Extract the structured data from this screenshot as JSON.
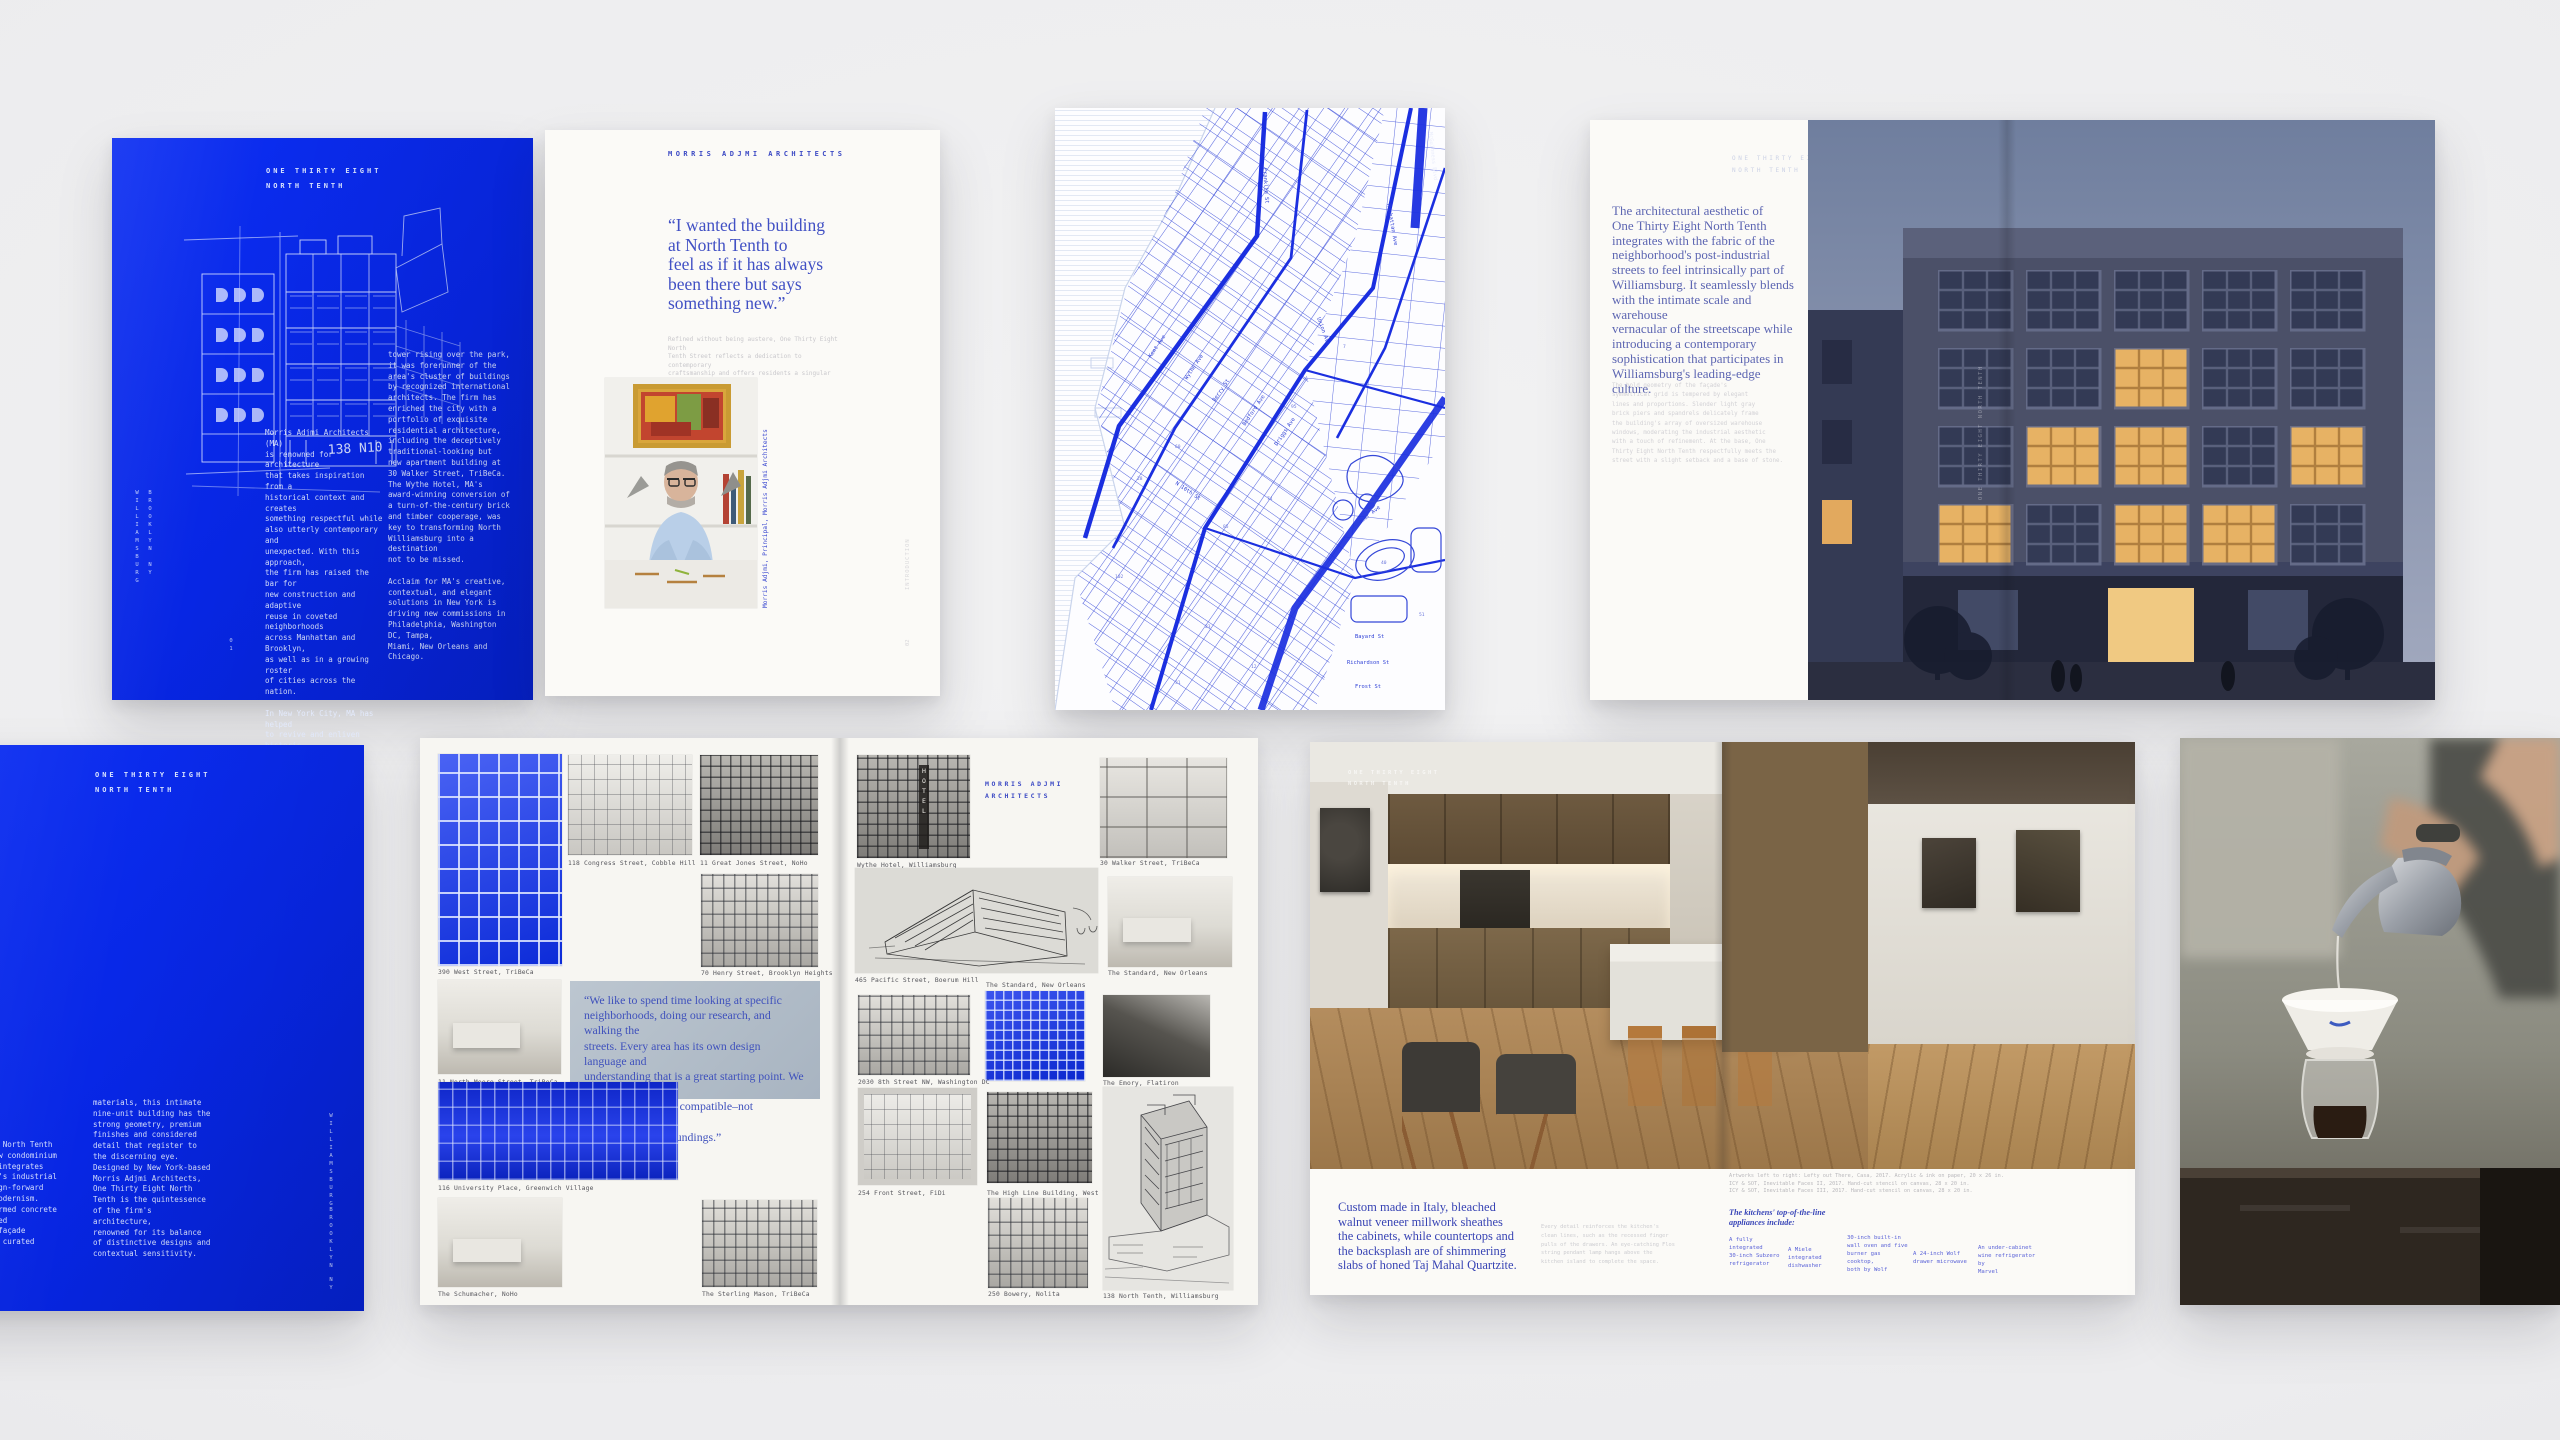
{
  "brand": {
    "blue": "#0726e4",
    "quote_blue": "#4653c8",
    "name": "MORRIS ADJMI ARCHITECTS",
    "project": "ONE THIRTY EIGHT NORTH TENTH"
  },
  "cover": {
    "title_line1": "ONE THIRTY EIGHT",
    "title_line2": "NORTH TENTH",
    "sketch_label": "138 N10",
    "vertical_a": "WILLIAMSBURG",
    "vertical_b": "BROOKLYN NY",
    "page_marker": "01",
    "col1": "Morris Adjmi Architects (MA)\nis renowned for architecture\nthat takes inspiration from a\nhistorical context and creates\nsomething respectful while\nalso utterly contemporary and\nunexpected. With this approach,\nthe firm has raised the bar for\nnew construction and adaptive\nreuse in coveted neighborhoods\nacross Manhattan and Brooklyn,\nas well as in a growing roster\nof cities across the nation.\n\nIn New York City, MA has helped\nto revive and enliven historic\nand landmarked neighborhoods such\nas the Meatpacking District with\nthe The High Line Building. An\niconic steel and glass office",
    "col2": "tower rising over the park,\nit was forerunner of the\narea's cluster of buildings\nby recognized international\narchitects. The firm has\nenriched the city with a\nportfolio of exquisite\nresidential architecture,\nincluding the deceptively\ntraditional-looking but\nnew apartment building at\n30 Walker Street, TriBeCa.\nThe Wythe Hotel, MA's\naward-winning conversion of\na turn-of-the-century brick\nand timber cooperage, was\nkey to transforming North\nWilliamsburg into a destination\nnot to be missed.\n\nAcclaim for MA's creative,\ncontextual, and elegant\nsolutions in New York is\ndriving new commissions in\nPhiladelphia, Washington DC, Tampa,\nMiami, New Orleans and Chicago."
  },
  "intro_page": {
    "header": "MORRIS ADJMI ARCHITECTS",
    "quote": "“I wanted the building\nat North Tenth to\nfeel as if it has always\nbeen there but says\nsomething new.”",
    "subtext": "Refined without being austere, One Thirty Eight North\nTenth Street reflects a dedication to contemporary\ncraftsmanship and offers residents a singular\narchitectural experience.",
    "portrait_caption": "Morris Adjmi, Principal, Morris Adjmi Architects",
    "side_vertical": "INTRODUCTION",
    "page_number": "02"
  },
  "map_page": {
    "labels": {
      "franklin": "Franklin St",
      "kent": "Kent Ave",
      "wythe": "Wythe Ave",
      "berry": "Berry St",
      "bedford": "Bedford Ave",
      "driggs": "Driggs Ave",
      "n10": "N 10th St",
      "union": "Union Ave",
      "manhattan": "Manhattan Ave",
      "mcguinness": "McGuinness Blvd",
      "bayard": "Bayard St",
      "richardson": "Richardson St",
      "frost": "Frost St",
      "meeker": "Meeker Ave"
    },
    "lot_numbers": [
      "28",
      "60",
      "85",
      "74",
      "40",
      "51",
      "23",
      "12",
      "95",
      "31",
      "102",
      "7"
    ]
  },
  "aesthetic_spread": {
    "header_line1": "ONE THIRTY EIGHT",
    "header_line2": "NORTH TENTH",
    "lead": "The architectural aesthetic of\nOne Thirty Eight North Tenth\nintegrates with the fabric of the\nneighborhood's post-industrial\nstreets to feel intrinsically part of\nWilliamsburg. It seamlessly blends\nwith the intimate scale and warehouse\nvernacular of the streetscape while\nintroducing a contemporary\nsophistication that participates in\nWilliamsburg's leading-edge culture.",
    "body": "The bold geometry of the façade's\nsymmetrical grid is tempered by elegant\nlines and proportions. Slender light gray\nbrick piers and spandrels delicately frame\nthe building's array of oversized warehouse\nwindows, moderating the industrial aesthetic\nwith a touch of refinement. At the base, One\nThirty Eight North Tenth respectfully meets the\nstreet with a slight setback and a base of stone.",
    "photo_vertical": "ONE THIRTY EIGHT NORTH TENTH"
  },
  "context_page": {
    "title_line1": "ONE THIRTY EIGHT",
    "title_line2": "NORTH TENTH",
    "col1": "One Thirty Eight North Tenth\nis a striking new condominium\nthat skillfully integrates\nthe neighborhood's industrial\npast with a design-forward\nnod to Italian Modernism.\nClad in board-formed concrete\nand the unexpected\ntonality of the façade\nwith judiciously curated",
    "col2": "materials, this intimate\nnine-unit building has the\nstrong geometry, premium\nfinishes and considered\ndetail that register to\nthe discerning eye.\nDesigned by New York-based\nMorris Adjmi Architects,\nOne Thirty Eight North\nTenth is the quintessence\nof the firm's architecture,\nrenowned for its balance\nof distinctive designs and\ncontextual sensitivity.",
    "vertical_a": "WILLIAMSBURG",
    "vertical_b": "BROOKLYN",
    "vertical_c": "NY"
  },
  "portfolio_spread": {
    "header_line1": "MORRIS ADJMI",
    "header_line2": "ARCHITECTS",
    "quote": "“We like to spend time looking at specific\nneighborhoods, doing our research, and walking the\nstreets. Every area has its own design language and\nunderstanding that is a great starting point. We look\nat materials that are compatible–not necessarily the\nsame–as their surroundings.”",
    "left_photos": [
      {
        "caption": "390 West Street, TriBeCa"
      },
      {
        "caption": "118 Congress Street, Cobble Hill"
      },
      {
        "caption": "11 Great Jones Street, NoHo"
      },
      {
        "caption": "70 Henry Street, Brooklyn Heights"
      },
      {
        "caption": "11 North Moore Street, TriBeCa"
      },
      {
        "caption": "116 University Place, Greenwich Village"
      },
      {
        "caption": "The Schumacher, NoHo"
      },
      {
        "caption": "The Sterling Mason, TriBeCa"
      }
    ],
    "right_photos": [
      {
        "caption": "Wythe Hotel, Williamsburg"
      },
      {
        "caption": "30 Walker Street, TriBeCa"
      },
      {
        "caption": "465 Pacific Street, Boerum Hill"
      },
      {
        "caption": "The Standard, New Orleans"
      },
      {
        "caption": "The Standard, New Orleans"
      },
      {
        "caption": "2030 8th Street NW, Washington DC"
      },
      {
        "caption": "The Emory, Flatiron"
      },
      {
        "caption": "254 Front Street, FiDi"
      },
      {
        "caption": "The High Line Building, West Village"
      },
      {
        "caption": "250 Bowery, Nolita"
      },
      {
        "caption": "138 North Tenth, Williamsburg"
      }
    ],
    "hotel_sign": "HOTEL"
  },
  "kitchen_spread": {
    "overlay_title1": "ONE THIRTY EIGHT",
    "overlay_title2": "NORTH TENTH",
    "statement": "Custom made in Italy, bleached\nwalnut veneer millwork sheathes\nthe cabinets, while countertops and\nthe backsplash are of shimmering\nslabs of honed Taj Mahal Quartzite.",
    "detail": "Every detail reinforces the kitchen's\nclean lines, such as the recessed finger\npulls of the drawers. An eye-catching Flos\nstring pendant lamp hangs above the\nkitchen island to complete the space.",
    "credits": "Artworks left to right: Lefty out There, Casa, 2017. Acrylic & ink on paper, 20 x 26 in.\nICY & SOT, Inevitable Faces II, 2017. Hand-cut stencil on canvas, 28 x 20 in.\nICY & SOT, Inevitable Faces III, 2017. Hand-cut stencil on canvas, 28 x 20 in.",
    "appliances_header": "The kitchens' top-of-the-line\nappliances include:",
    "appliances": [
      "A fully\nintegrated\n30-inch Subzero\nrefrigerator",
      "A Miele\nintegrated\ndishwasher",
      "30-inch built-in\nwall oven and five\nburner gas cooktop,\nboth by Wolf",
      "A 24-inch Wolf\ndrawer microwave",
      "An under-cabinet\nwine refrigerator by\nMarvel"
    ]
  }
}
